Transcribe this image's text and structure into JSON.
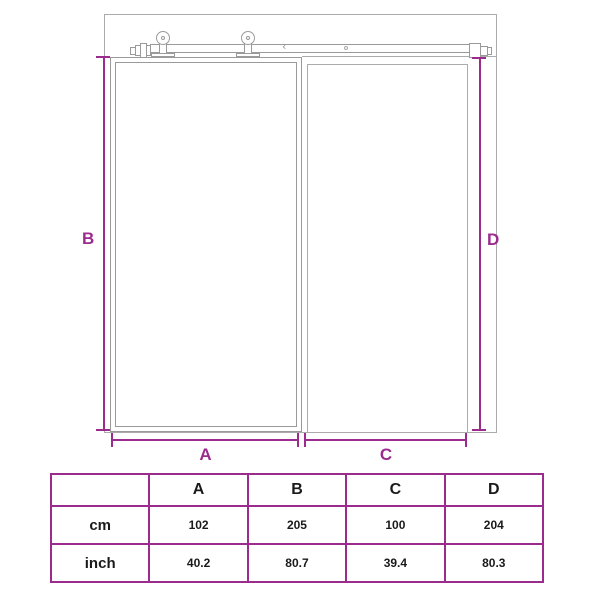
{
  "diagram": {
    "labels": {
      "a": "A",
      "b": "B",
      "c": "C",
      "d": "D"
    },
    "rail_notch": "‹"
  },
  "table": {
    "columns": [
      "",
      "A",
      "B",
      "C",
      "D"
    ],
    "rows": [
      {
        "label": "cm",
        "values": [
          "102",
          "205",
          "100",
          "204"
        ]
      },
      {
        "label": "inch",
        "values": [
          "40.2",
          "80.7",
          "39.4",
          "80.3"
        ]
      }
    ]
  },
  "colors": {
    "accent": "#9C2B8E",
    "outline": "#ABABAB",
    "outline_dark": "#9A9A9A",
    "table_text": "#1A1A1A",
    "background": "#FFFFFF"
  }
}
